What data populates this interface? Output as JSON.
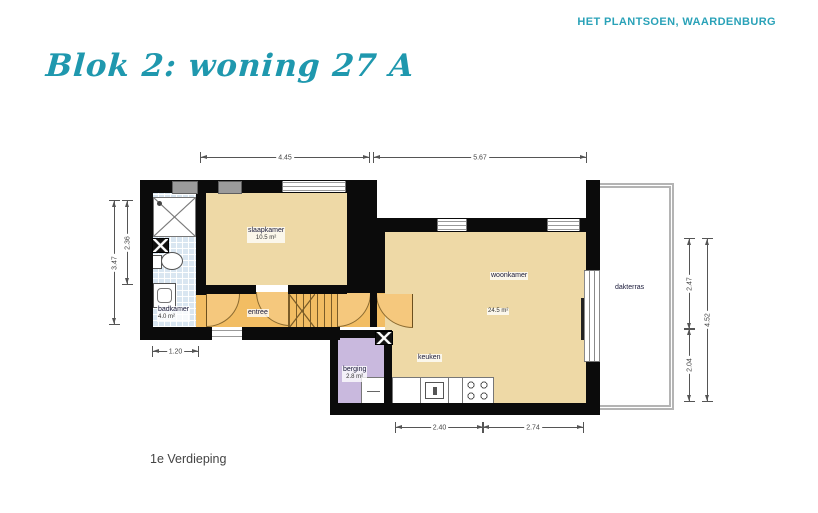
{
  "page": {
    "project_label": "HET PLANTSOEN, WAARDENBURG",
    "title": "Blok 2: woning 27 A",
    "floor_label": "1e Verdieping"
  },
  "rooms": {
    "slaapkamer": {
      "name": "slaapkamer",
      "area": "10.5 m²"
    },
    "woonkamer": {
      "name": "woonkamer",
      "area": "24.5 m²"
    },
    "badkamer": {
      "name": "badkamer",
      "area": "4.0 m²"
    },
    "berging": {
      "name": "berging",
      "area": "2.8 m²"
    },
    "entree": {
      "name": "entree"
    },
    "keuken": {
      "name": "keuken"
    },
    "dakterras": {
      "name": "dakterras"
    }
  },
  "dimensions": {
    "top_left": "4.45",
    "top_right": "5.67",
    "left_outer": "3.47",
    "left_inner": "2.36",
    "badkamer_width": "1.20",
    "bottom_left": "2.40",
    "bottom_right": "2.74",
    "right_top": "2.47",
    "right_bottom": "2.04",
    "right_outer": "4.52"
  },
  "colors": {
    "accent_teal": "#1f98ae",
    "wall_black": "#0b0b0b",
    "floor_beige": "#eed9a6",
    "floor_orange": "#f2bd63",
    "floor_purple": "#c9b9de",
    "tile_blue": "#d9e6f1",
    "railing_gray": "#b4b4b4"
  }
}
